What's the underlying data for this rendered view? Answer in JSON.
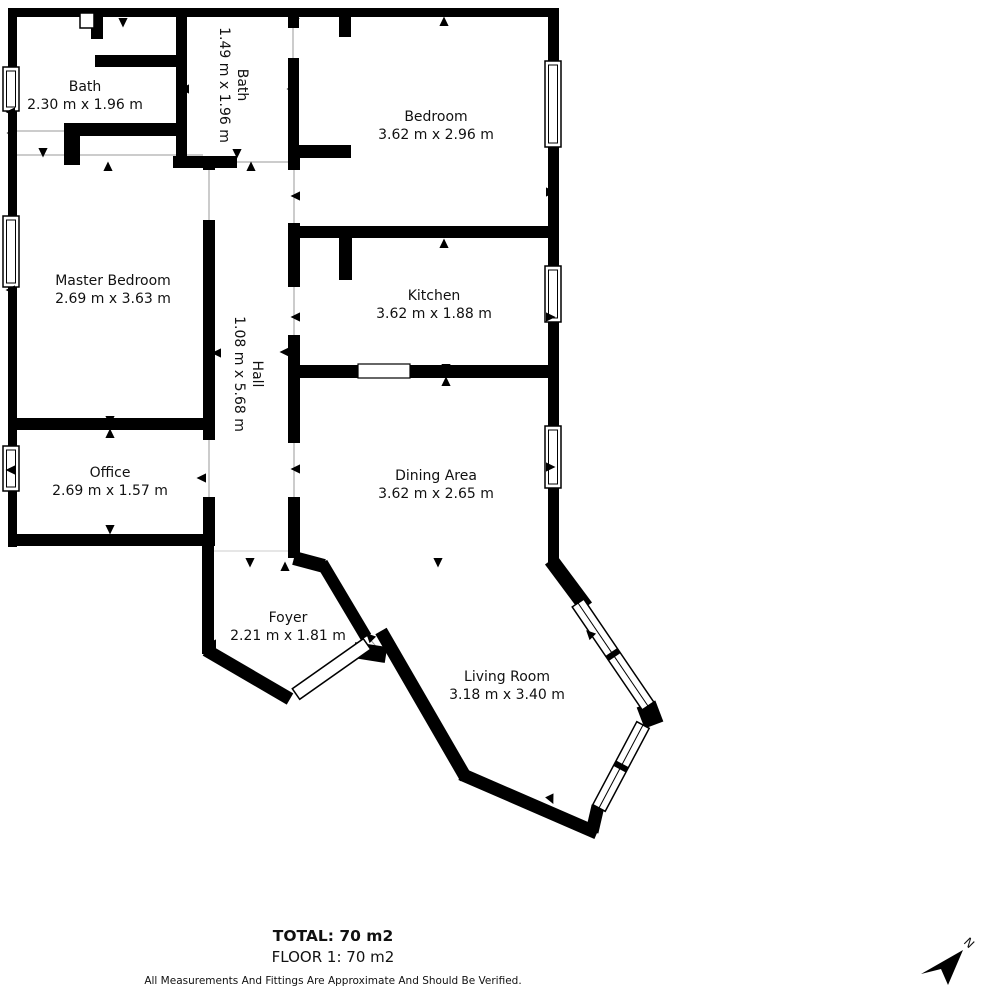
{
  "floorplan": {
    "rooms": [
      {
        "id": "bath-1",
        "name": "Bath",
        "dims": "2.30 m x 1.96 m"
      },
      {
        "id": "bath-2",
        "name": "Bath",
        "dims": "1.49 m x 1.96 m"
      },
      {
        "id": "bedroom",
        "name": "Bedroom",
        "dims": "3.62 m x 2.96 m"
      },
      {
        "id": "master-bedroom",
        "name": "Master Bedroom",
        "dims": "2.69 m x 3.63 m"
      },
      {
        "id": "kitchen",
        "name": "Kitchen",
        "dims": "3.62 m x 1.88 m"
      },
      {
        "id": "hall",
        "name": "Hall",
        "dims": "1.08 m x 5.68 m"
      },
      {
        "id": "office",
        "name": "Office",
        "dims": "2.69 m x 1.57 m"
      },
      {
        "id": "dining-area",
        "name": "Dining Area",
        "dims": "3.62 m x 2.65 m"
      },
      {
        "id": "foyer",
        "name": "Foyer",
        "dims": "2.21 m x 1.81 m"
      },
      {
        "id": "living-room",
        "name": "Living Room",
        "dims": "3.18 m x 3.40 m"
      }
    ],
    "footer": {
      "total": "TOTAL: 70 m2",
      "floor": "FLOOR 1: 70 m2",
      "disclaimer": "All Measurements And Fittings Are Approximate And Should Be Verified."
    },
    "compass": {
      "label": "N"
    },
    "colors": {
      "wall": "#000000",
      "background": "#ffffff",
      "text": "#111111",
      "opening_line": "#999999"
    }
  }
}
